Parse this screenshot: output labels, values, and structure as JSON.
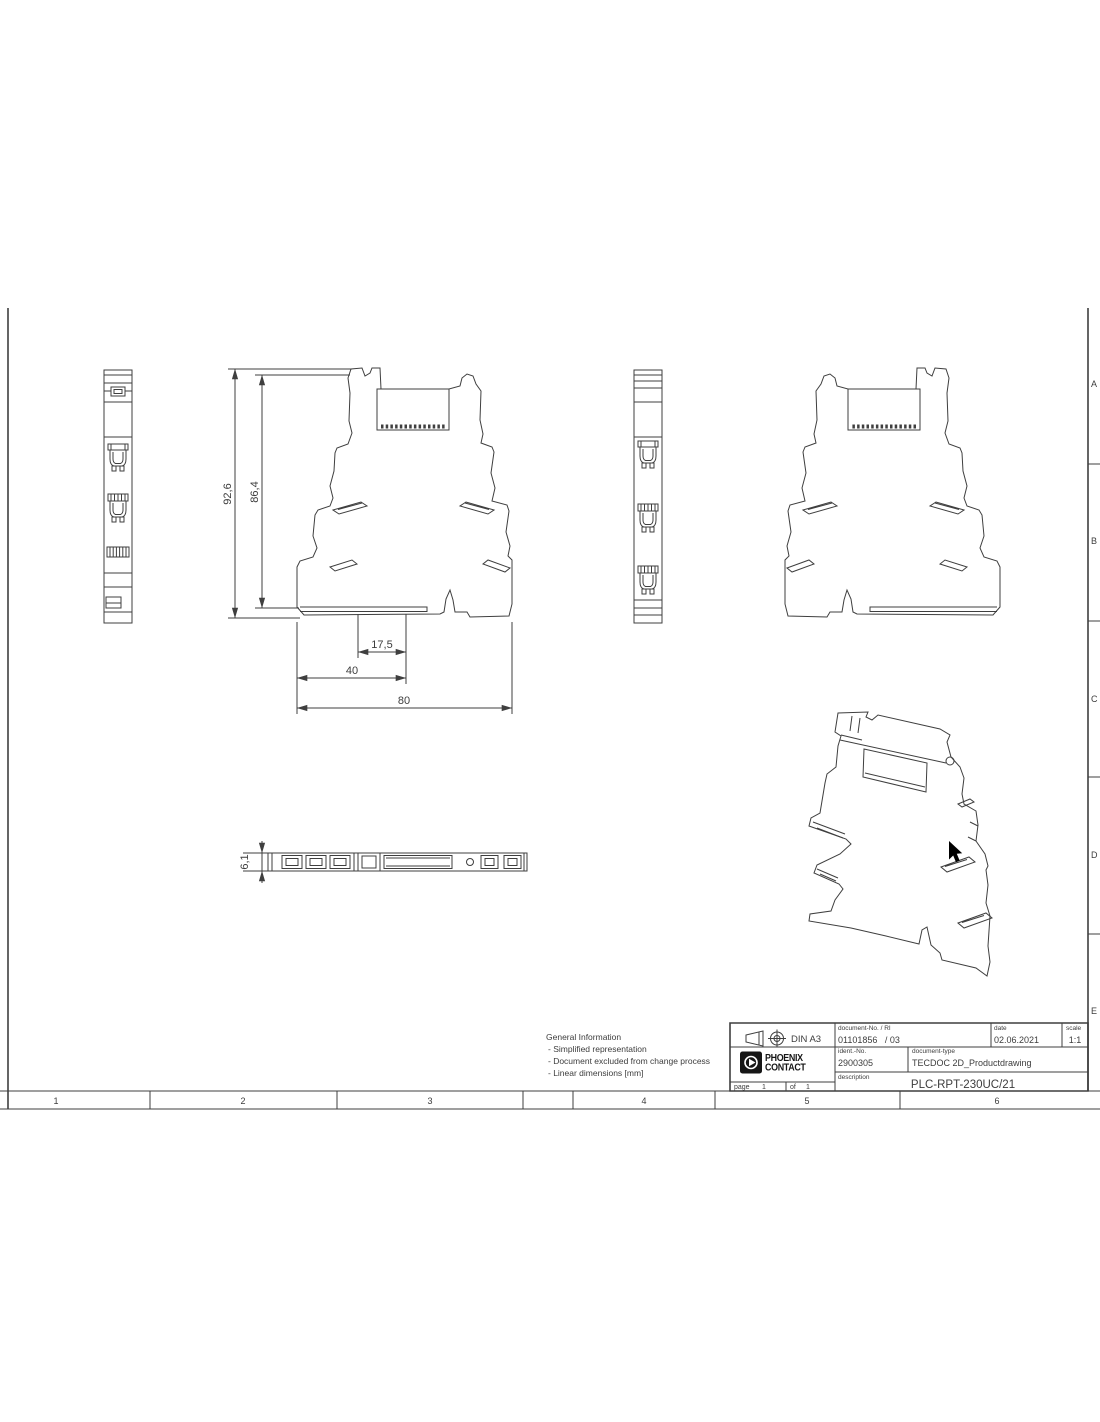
{
  "colors": {
    "line": "#3f3f3f",
    "text": "#3d3d3d",
    "logo_black": "#161616",
    "background": "#ffffff"
  },
  "frame": {
    "zone_letters": [
      "A",
      "B",
      "C",
      "D",
      "E"
    ],
    "zone_numbers": [
      "1",
      "2",
      "3",
      "4",
      "5",
      "6"
    ]
  },
  "dimensions": {
    "overall_height": "92,6",
    "body_height": "86,4",
    "offset_width": "17,5",
    "rail_width": "40",
    "overall_width": "80",
    "thickness": "6,1"
  },
  "general_information": {
    "title": "General Information",
    "items": [
      "- Simplified representation",
      "- Document excluded from change process",
      "- Linear dimensions [mm]"
    ]
  },
  "title_block": {
    "standard": "DIN A3",
    "document_no_label": "document-No. / RI",
    "document_no_value": "01101856   / 03",
    "date_label": "date",
    "date_value": "02.06.2021",
    "scale_label": "scale",
    "scale_value": "1:1",
    "ident_no_label": "ident.-No.",
    "ident_no_value": "2900305",
    "document_type_label": "document-type",
    "document_type_value": "TECDOC 2D_Productdrawing",
    "description_label": "description",
    "description_value": "PLC-RPT-230UC/21",
    "page_label": "page",
    "page_value": "1",
    "of_label": "of",
    "of_value": "1",
    "logo_line1": "PHOENIX",
    "logo_line2": "CONTACT"
  }
}
